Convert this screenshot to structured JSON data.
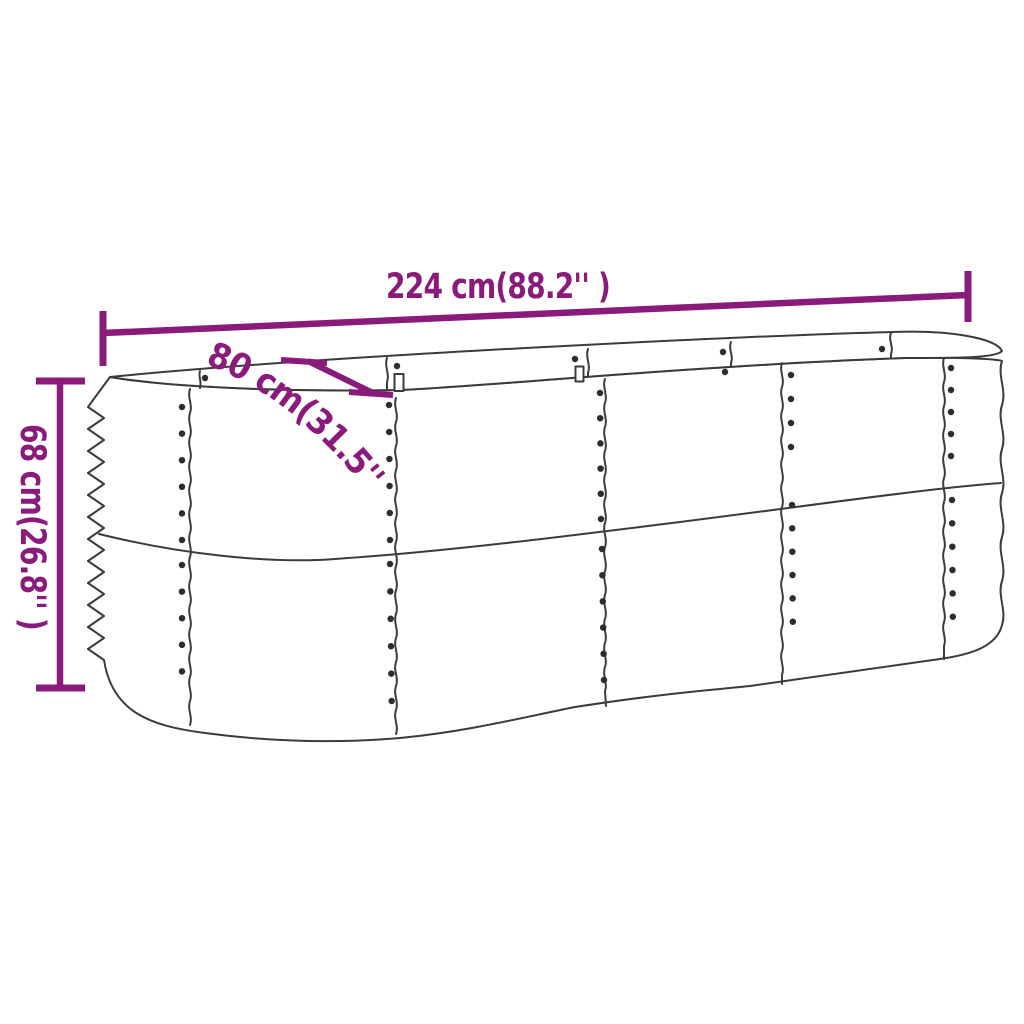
{
  "figure": {
    "kind": "product-dimension-line-drawing",
    "depicts": "oval corrugated-metal raised garden bed planter, 3/4 perspective view, with riveted panel seams and rim brackets"
  },
  "colors": {
    "accent": "#8a1b7a",
    "ink": "#3b3b3b",
    "rivet": "#2d2d2d",
    "background": "#ffffff"
  },
  "dimensions": {
    "length": {
      "label": "224 cm(88.2'' )",
      "value_cm": 224,
      "value_inches": 88.2
    },
    "width": {
      "label": "80 cm(31.5'' )",
      "value_cm": 80,
      "value_inches": 31.5
    },
    "height": {
      "label": "68 cm(26.8'' )",
      "value_cm": 68,
      "value_inches": 26.8
    }
  }
}
